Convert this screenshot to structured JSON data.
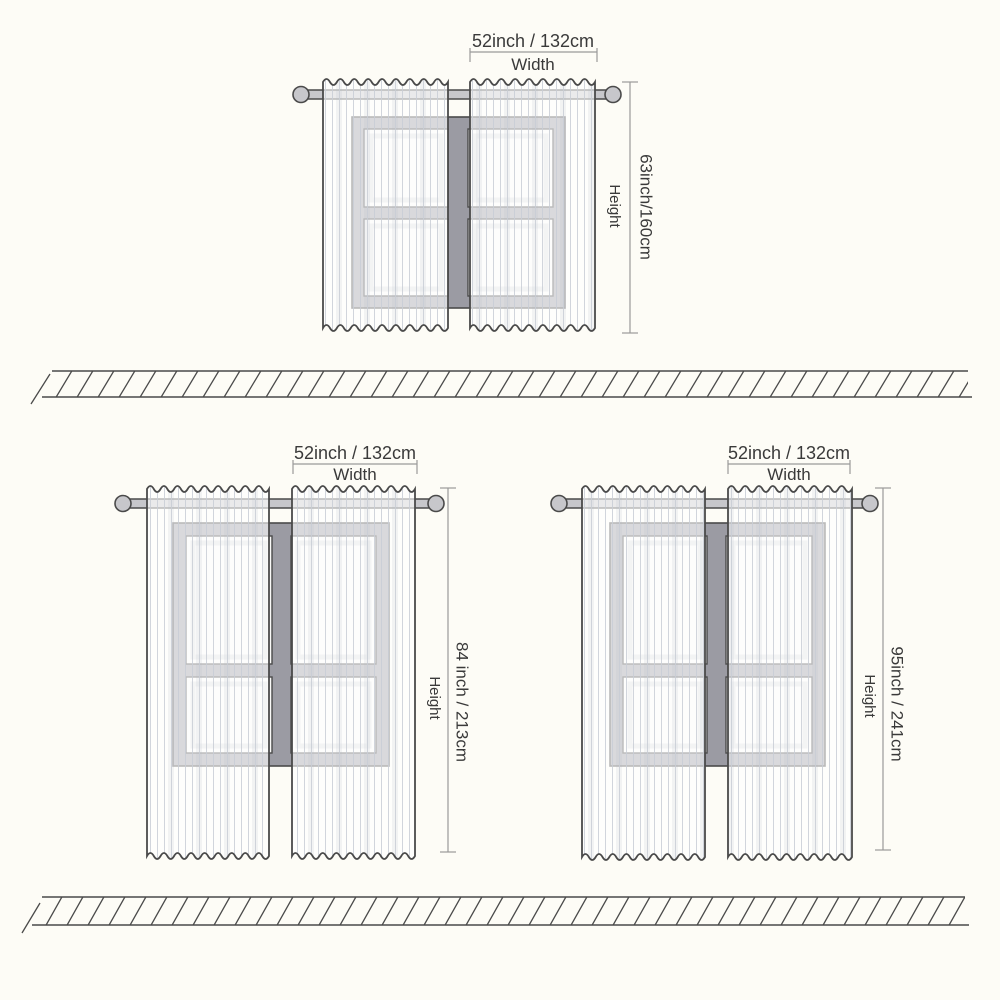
{
  "colors": {
    "bg": "#fdfcf6",
    "ink": "#3a3a3a",
    "edge": "#4a4a4a",
    "dim": "#9a9a9a",
    "frame": "#9b9ba3",
    "pane": "#fafaf8",
    "rod": "#c7c7cb",
    "stripe": "#c9ced6"
  },
  "diagrams": [
    {
      "width_value": "52inch / 132cm",
      "width_word": "Width",
      "height_value": "63inch/160cm",
      "height_word": "Height"
    },
    {
      "width_value": "52inch / 132cm",
      "width_word": "Width",
      "height_value": "84 inch / 213cm",
      "height_word": "Height"
    },
    {
      "width_value": "52inch / 132cm",
      "width_word": "Width",
      "height_value": "95inch / 241cm",
      "height_word": "Height"
    }
  ]
}
